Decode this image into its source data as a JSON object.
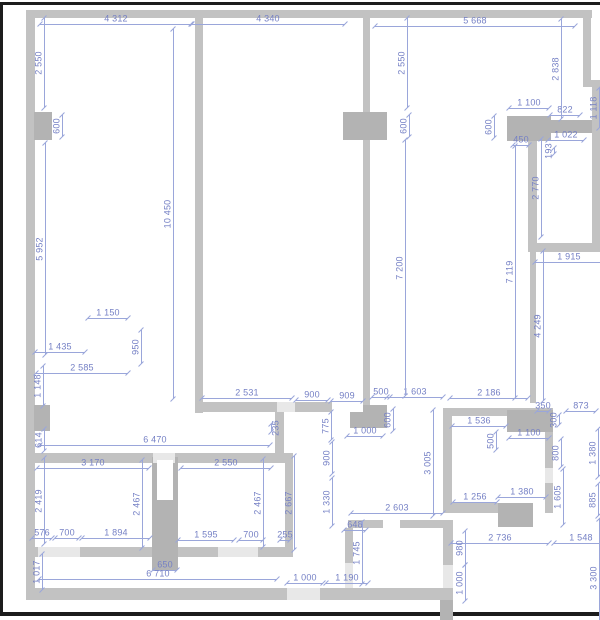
{
  "description": "Architectural floor plan drawing with gray walls and blue dimension annotations in millimetres",
  "units": "mm",
  "colors": {
    "background": "#ffffff",
    "frame": "#1c1c1c",
    "wall": "#c2c2c2",
    "wall_dark": "#b3b3b3",
    "opening": "#e8e8e8",
    "dim_text": "#7580c5",
    "dim_line": "#9aa6da"
  },
  "plan": {
    "scale_mm_per_px": 28.2,
    "frame": [
      {
        "x": 0,
        "y": 2,
        "w": 600,
        "h": 3
      },
      {
        "x": 0,
        "y": 2,
        "w": 3,
        "h": 614
      },
      {
        "x": 0,
        "y": 612,
        "w": 600,
        "h": 4
      }
    ],
    "walls": [
      {
        "x": 26,
        "y": 10,
        "w": 566,
        "h": 8
      },
      {
        "x": 26,
        "y": 10,
        "w": 9,
        "h": 590
      },
      {
        "x": 26,
        "y": 588,
        "w": 427,
        "h": 12
      },
      {
        "x": 34,
        "y": 112,
        "w": 18,
        "h": 28,
        "d": 1
      },
      {
        "x": 34,
        "y": 405,
        "w": 16,
        "h": 26,
        "d": 1
      },
      {
        "x": 195,
        "y": 18,
        "w": 8,
        "h": 395
      },
      {
        "x": 363,
        "y": 18,
        "w": 7,
        "h": 390
      },
      {
        "x": 343,
        "y": 112,
        "w": 44,
        "h": 28,
        "d": 1
      },
      {
        "x": 507,
        "y": 116,
        "w": 44,
        "h": 25,
        "d": 1
      },
      {
        "x": 583,
        "y": 18,
        "w": 8,
        "h": 62
      },
      {
        "x": 583,
        "y": 80,
        "w": 17,
        "h": 7
      },
      {
        "x": 592,
        "y": 86,
        "w": 8,
        "h": 166
      },
      {
        "x": 550,
        "y": 120,
        "w": 42,
        "h": 13,
        "d": 1
      },
      {
        "x": 528,
        "y": 141,
        "w": 9,
        "h": 102
      },
      {
        "x": 528,
        "y": 243,
        "w": 72,
        "h": 9
      },
      {
        "x": 530,
        "y": 252,
        "w": 6,
        "h": 151
      },
      {
        "x": 197,
        "y": 402,
        "w": 80,
        "h": 10
      },
      {
        "x": 295,
        "y": 402,
        "w": 37,
        "h": 10
      },
      {
        "x": 350,
        "y": 405,
        "w": 37,
        "h": 23,
        "d": 1
      },
      {
        "x": 275,
        "y": 412,
        "w": 9,
        "h": 43
      },
      {
        "x": 33,
        "y": 453,
        "w": 260,
        "h": 10
      },
      {
        "x": 285,
        "y": 453,
        "w": 8,
        "h": 104
      },
      {
        "x": 33,
        "y": 547,
        "w": 260,
        "h": 10
      },
      {
        "x": 152,
        "y": 457,
        "w": 26,
        "h": 113,
        "d": 1
      },
      {
        "x": 443,
        "y": 408,
        "w": 9,
        "h": 105
      },
      {
        "x": 443,
        "y": 408,
        "w": 110,
        "h": 8
      },
      {
        "x": 507,
        "y": 410,
        "w": 46,
        "h": 22,
        "d": 1
      },
      {
        "x": 545,
        "y": 432,
        "w": 8,
        "h": 81
      },
      {
        "x": 443,
        "y": 503,
        "w": 103,
        "h": 10
      },
      {
        "x": 498,
        "y": 503,
        "w": 35,
        "h": 24,
        "d": 1
      },
      {
        "x": 348,
        "y": 520,
        "w": 100,
        "h": 8
      },
      {
        "x": 345,
        "y": 528,
        "w": 8,
        "h": 60
      },
      {
        "x": 443,
        "y": 520,
        "w": 10,
        "h": 68
      },
      {
        "x": 440,
        "y": 600,
        "w": 13,
        "h": 20,
        "d": 1
      }
    ],
    "openings": [
      {
        "x": 287,
        "y": 588,
        "w": 33,
        "h": 12,
        "f": "light"
      },
      {
        "x": 153,
        "y": 453,
        "w": 22,
        "h": 10,
        "f": "light"
      },
      {
        "x": 38,
        "y": 547,
        "w": 42,
        "h": 10,
        "f": "light"
      },
      {
        "x": 218,
        "y": 547,
        "w": 40,
        "h": 10,
        "f": "light"
      },
      {
        "x": 277,
        "y": 402,
        "w": 18,
        "h": 10,
        "f": "light"
      },
      {
        "x": 332,
        "y": 402,
        "w": 31,
        "h": 10,
        "f": "white"
      },
      {
        "x": 545,
        "y": 468,
        "w": 8,
        "h": 15,
        "f": "light"
      },
      {
        "x": 383,
        "y": 520,
        "w": 17,
        "h": 8,
        "f": "white"
      },
      {
        "x": 345,
        "y": 563,
        "w": 8,
        "h": 25,
        "f": "light"
      },
      {
        "x": 443,
        "y": 565,
        "w": 10,
        "h": 23,
        "f": "light"
      },
      {
        "x": 533,
        "y": 503,
        "w": 12,
        "h": 10,
        "f": "white"
      },
      {
        "x": 157,
        "y": 460,
        "w": 16,
        "h": 40,
        "f": "white"
      }
    ],
    "dims": [
      {
        "t": "4 312",
        "x": 116,
        "y": 19,
        "o": "h"
      },
      {
        "t": "4 340",
        "x": 268,
        "y": 19,
        "o": "h"
      },
      {
        "t": "5 668",
        "x": 475,
        "y": 21,
        "o": "h"
      },
      {
        "t": "1 100",
        "x": 529,
        "y": 103,
        "o": "h"
      },
      {
        "t": "822",
        "x": 565,
        "y": 110,
        "o": "h"
      },
      {
        "t": "1 022",
        "x": 566,
        "y": 135,
        "o": "h"
      },
      {
        "t": "450",
        "x": 521,
        "y": 140,
        "o": "h"
      },
      {
        "t": "1 915",
        "x": 569,
        "y": 257,
        "o": "h"
      },
      {
        "t": "1 150",
        "x": 108,
        "y": 313,
        "o": "h"
      },
      {
        "t": "1 435",
        "x": 60,
        "y": 347,
        "o": "h"
      },
      {
        "t": "2 585",
        "x": 82,
        "y": 368,
        "o": "h"
      },
      {
        "t": "2 531",
        "x": 247,
        "y": 393,
        "o": "h"
      },
      {
        "t": "900",
        "x": 312,
        "y": 395,
        "o": "h"
      },
      {
        "t": "909",
        "x": 347,
        "y": 396,
        "o": "h"
      },
      {
        "t": "500",
        "x": 381,
        "y": 392,
        "o": "h"
      },
      {
        "t": "1 603",
        "x": 415,
        "y": 392,
        "o": "h"
      },
      {
        "t": "2 186",
        "x": 489,
        "y": 393,
        "o": "h"
      },
      {
        "t": "350",
        "x": 543,
        "y": 406,
        "o": "h"
      },
      {
        "t": "873",
        "x": 581,
        "y": 406,
        "o": "h"
      },
      {
        "t": "1 000",
        "x": 365,
        "y": 431,
        "o": "h"
      },
      {
        "t": "1 536",
        "x": 479,
        "y": 421,
        "o": "h"
      },
      {
        "t": "1 100",
        "x": 529,
        "y": 433,
        "o": "h"
      },
      {
        "t": "6 470",
        "x": 155,
        "y": 440,
        "o": "h"
      },
      {
        "t": "3 170",
        "x": 93,
        "y": 463,
        "o": "h"
      },
      {
        "t": "2 550",
        "x": 226,
        "y": 463,
        "o": "h"
      },
      {
        "t": "1 256",
        "x": 475,
        "y": 497,
        "o": "h"
      },
      {
        "t": "1 380",
        "x": 522,
        "y": 492,
        "o": "h"
      },
      {
        "t": "2 603",
        "x": 397,
        "y": 508,
        "o": "h"
      },
      {
        "t": "648",
        "x": 355,
        "y": 525,
        "o": "h"
      },
      {
        "t": "576",
        "x": 42,
        "y": 533,
        "o": "h"
      },
      {
        "t": "700",
        "x": 67,
        "y": 533,
        "o": "h"
      },
      {
        "t": "1 894",
        "x": 116,
        "y": 533,
        "o": "h"
      },
      {
        "t": "1 595",
        "x": 206,
        "y": 535,
        "o": "h"
      },
      {
        "t": "700",
        "x": 251,
        "y": 535,
        "o": "h"
      },
      {
        "t": "255",
        "x": 285,
        "y": 535,
        "o": "h"
      },
      {
        "t": "2 736",
        "x": 500,
        "y": 538,
        "o": "h"
      },
      {
        "t": "1 548",
        "x": 581,
        "y": 538,
        "o": "h"
      },
      {
        "t": "650",
        "x": 165,
        "y": 565,
        "o": "h"
      },
      {
        "t": "6 710",
        "x": 158,
        "y": 574,
        "o": "h"
      },
      {
        "t": "1 000",
        "x": 305,
        "y": 578,
        "o": "h"
      },
      {
        "t": "1 190",
        "x": 347,
        "y": 578,
        "o": "h"
      },
      {
        "t": "2 550",
        "x": 39,
        "y": 63,
        "o": "v"
      },
      {
        "t": "2 550",
        "x": 402,
        "y": 63,
        "o": "v"
      },
      {
        "t": "2 838",
        "x": 556,
        "y": 69,
        "o": "v"
      },
      {
        "t": "600",
        "x": 57,
        "y": 126,
        "o": "v"
      },
      {
        "t": "600",
        "x": 404,
        "y": 126,
        "o": "v"
      },
      {
        "t": "600",
        "x": 489,
        "y": 127,
        "o": "v"
      },
      {
        "t": "1 118",
        "x": 594,
        "y": 108,
        "o": "v"
      },
      {
        "t": "193",
        "x": 549,
        "y": 151,
        "o": "v"
      },
      {
        "t": "2 770",
        "x": 536,
        "y": 188,
        "o": "v"
      },
      {
        "t": "10 450",
        "x": 168,
        "y": 214,
        "o": "v"
      },
      {
        "t": "5 952",
        "x": 40,
        "y": 249,
        "o": "v"
      },
      {
        "t": "7 200",
        "x": 400,
        "y": 268,
        "o": "v"
      },
      {
        "t": "7 119",
        "x": 510,
        "y": 272,
        "o": "v"
      },
      {
        "t": "4 249",
        "x": 538,
        "y": 326,
        "o": "v"
      },
      {
        "t": "950",
        "x": 136,
        "y": 347,
        "o": "v"
      },
      {
        "t": "1 148",
        "x": 38,
        "y": 386,
        "o": "v"
      },
      {
        "t": "235",
        "x": 276,
        "y": 428,
        "o": "v",
        "s": -1
      },
      {
        "t": "775",
        "x": 326,
        "y": 426,
        "o": "v"
      },
      {
        "t": "600",
        "x": 388,
        "y": 420,
        "o": "v"
      },
      {
        "t": "300",
        "x": 554,
        "y": 420,
        "o": "v"
      },
      {
        "t": "500",
        "x": 491,
        "y": 441,
        "o": "v"
      },
      {
        "t": "1 380",
        "x": 593,
        "y": 453,
        "o": "v"
      },
      {
        "t": "800",
        "x": 556,
        "y": 453,
        "o": "v"
      },
      {
        "t": "900",
        "x": 327,
        "y": 458,
        "o": "v"
      },
      {
        "t": "3 005",
        "x": 428,
        "y": 463,
        "o": "v"
      },
      {
        "t": "614",
        "x": 39,
        "y": 440,
        "o": "v"
      },
      {
        "t": "2 419",
        "x": 39,
        "y": 501,
        "o": "v"
      },
      {
        "t": "2 467",
        "x": 137,
        "y": 504,
        "o": "v"
      },
      {
        "t": "2 467",
        "x": 258,
        "y": 503,
        "o": "v"
      },
      {
        "t": "2 667",
        "x": 289,
        "y": 503,
        "o": "v"
      },
      {
        "t": "1 330",
        "x": 327,
        "y": 502,
        "o": "v"
      },
      {
        "t": "1 605",
        "x": 558,
        "y": 497,
        "o": "v"
      },
      {
        "t": "885",
        "x": 593,
        "y": 500,
        "o": "v"
      },
      {
        "t": "1 745",
        "x": 357,
        "y": 553,
        "o": "v"
      },
      {
        "t": "980",
        "x": 460,
        "y": 548,
        "o": "v"
      },
      {
        "t": "1 017",
        "x": 37,
        "y": 572,
        "o": "v"
      },
      {
        "t": "1 000",
        "x": 460,
        "y": 583,
        "o": "v"
      },
      {
        "t": "3 300",
        "x": 594,
        "y": 578,
        "o": "v"
      }
    ]
  }
}
